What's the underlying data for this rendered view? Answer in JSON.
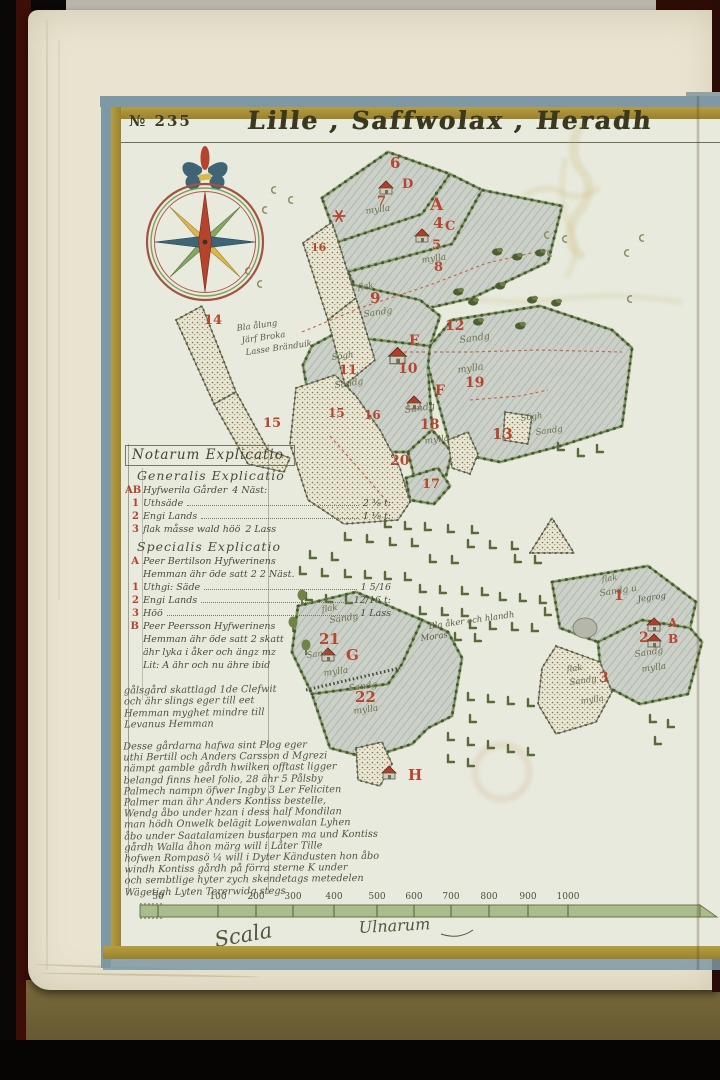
{
  "page": {
    "folio_mark": "№",
    "folio_number": "235",
    "title": "Lille , Saffwolax , Heradh"
  },
  "legend": {
    "title": "Notarum Explicatio",
    "sections": [
      {
        "heading": "Generalis Explicatio",
        "rows": [
          {
            "key": "AB",
            "text": "Hyfwerila Gårder",
            "value": "4 Näst:"
          },
          {
            "key": "1",
            "text": "Uthsäde",
            "leader": true,
            "value": "2 ⅜ t:"
          },
          {
            "key": "2",
            "text": "Engi Lands",
            "leader": true,
            "value": "1 ⅛ t:"
          },
          {
            "key": "3",
            "text": "flak måsse wald höö",
            "value": "2 Lass"
          }
        ]
      },
      {
        "heading": "Specialis Explicatio",
        "rows": [
          {
            "key": "A",
            "text": "Peer Bertilson Hyfwerinens"
          },
          {
            "text": "Hemman ähr öde satt 2 2 Näst."
          },
          {
            "key": "1",
            "text": "Uthgi: Säde",
            "leader": true,
            "value": "1 5/16"
          },
          {
            "key": "2",
            "text": "Engi Lands",
            "leader": true,
            "value": "12/16 t:"
          },
          {
            "key": "3",
            "text": "Höö",
            "leader": true,
            "value": "1 Lass"
          },
          {
            "key": "B",
            "text": "Peer Peersson Hyfwerinens"
          },
          {
            "text": "Hemman ähr öde satt 2 skatt"
          },
          {
            "text": "ähr lyka i åker och ängz mz"
          },
          {
            "text": "Lit: A ähr och nu ähre ibid"
          }
        ]
      }
    ],
    "note_lines": [
      "gålsgård skattlagd 1de Clefwit",
      "och ähr slings eger till eet",
      "Hemman myghet mindre till",
      "Levanus Hemman"
    ],
    "paragraph_lines": [
      "Desse gårdarna hafwa sint Plog eger",
      "uthi Bertill och Anders Carsson d Mgrezi",
      "nämpt gamble gårdh hwilken offtast ligger",
      "belangd finns heel folio, 28 ähr 5 Pålsby",
      "Palmech nampn öfwer Ingby 3 Ler Feliciten",
      "Palmer man ähr Anders Kontiss bestelle,",
      "Wendg åbo under hzan i dess half Mondilan",
      "man hödh Onwelk belägit Lowenwalan Lyhen",
      "åbo under Saatalamizen bustarpen ma und Kontiss",
      "gårdh Walla åhon märg will i Låter Tille",
      "hofwen Rompasö ¼ will i Dyter Kändusten hon åbo",
      "windh Kontiss gårdh på förra sterne K under",
      "och sembtlige hyter zych skendetags metedelen",
      "Wägetigh Lyten Tererwidg stegs"
    ]
  },
  "map": {
    "labels": {
      "n6": "6",
      "nD": "D",
      "n7": "7",
      "m7": "mylla",
      "nA": "A",
      "n4": "4",
      "nC": "C",
      "n5": "5",
      "m5": "mylla",
      "n8": "8",
      "n16a": "16",
      "flak9": "flak",
      "n9": "9",
      "sandg9": "Sandg",
      "n14": "14",
      "n15s": "15",
      "note1": "Bla ålung",
      "note2": "Järf Broka",
      "note3": "Lasse Bränduik",
      "sogh11": "Sögh",
      "n11": "11",
      "sandg11": "Sandg",
      "n12": "12",
      "sandg12": "Sandg",
      "nE": "E",
      "n10": "10",
      "mylla19": "mylla",
      "n19": "19",
      "nF": "F",
      "sandgF": "Sandg",
      "n18": "18",
      "mylla18": "mylla",
      "n15b": "15",
      "n16b": "16",
      "n20": "20",
      "n17": "17",
      "n13": "13",
      "sogh13": "Sögh",
      "sandg13": "Sandg",
      "mnote1": "Bla åker och hlandh",
      "mnote2": "Moras",
      "flak21": "flak",
      "sandg21": "Sandg",
      "n21": "21",
      "sand21": "Sand",
      "nG": "G",
      "mylla21": "mylla",
      "sandg22": "Sandg",
      "n22": "22",
      "mylla22": "mylla",
      "nH": "H",
      "flak1": "flak",
      "sandg1": "Sandg u",
      "n1": "1",
      "jeg1": "Jegrog",
      "n2": "2",
      "sandg2": "Sandg",
      "mylla2": "mylla",
      "nA2": "A",
      "nB2": "B",
      "flak3": "flak",
      "sandg3": "Sandg",
      "n3": "3",
      "mylla3": "mylla"
    }
  },
  "scale": {
    "ticks": [
      "50",
      "100",
      "200",
      "300",
      "400",
      "500",
      "600",
      "700",
      "800",
      "900",
      "1000"
    ],
    "caption_left": "Scala",
    "caption_right": "Ulnarum"
  },
  "colors": {
    "red_ink": "#b5442f",
    "frame_gold": "#ab9238",
    "frame_blue": "#7e98a6",
    "field_edge_green": "#9db87a",
    "compass_north": "#b5442f",
    "compass_east_west": "#3e6476",
    "compass_diag_green": "#86a75e",
    "compass_diag_yellow": "#d8b84e"
  }
}
